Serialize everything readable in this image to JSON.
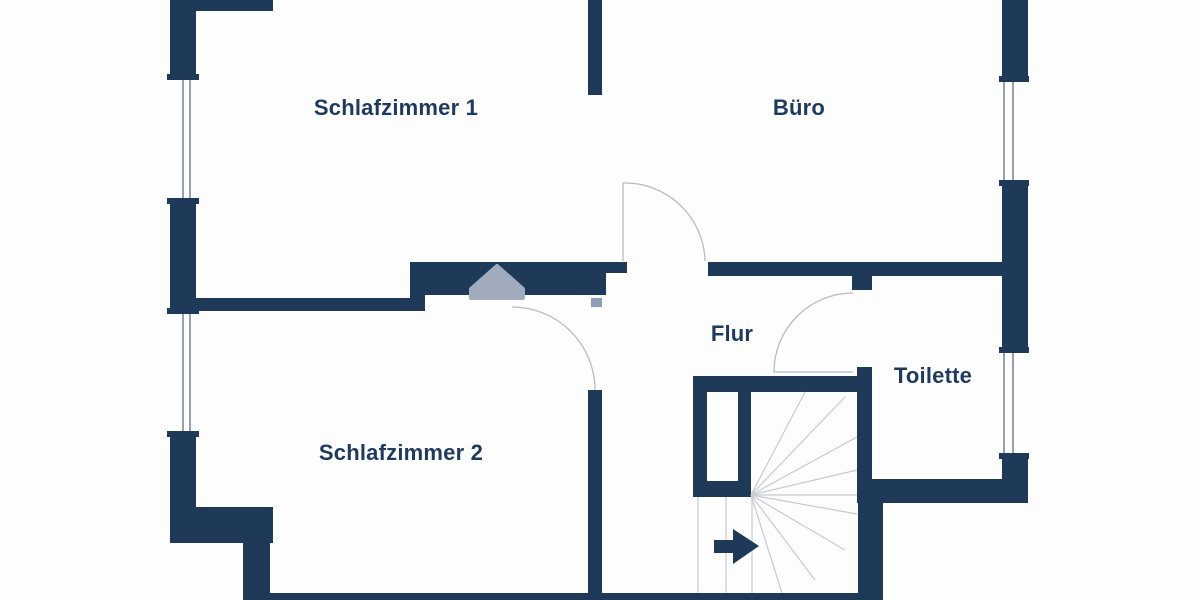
{
  "meta": {
    "type": "floor-plan",
    "language": "de"
  },
  "colors": {
    "wall": "#1f3a59",
    "text": "#1e3a5c",
    "door_arc": "#b6bcc6",
    "stair_tread": "#c6cad1",
    "window_line": "#72819a",
    "gable_symbol": "#a0acbe",
    "door_hinge": "#8fa0b5",
    "background": "#fdfdfe"
  },
  "rooms": [
    {
      "id": "schlafzimmer-1",
      "label": "Schlafzimmer 1",
      "cx": 396,
      "cy": 108
    },
    {
      "id": "buero",
      "label": "Büro",
      "cx": 799,
      "cy": 108
    },
    {
      "id": "flur",
      "label": "Flur",
      "cx": 732,
      "cy": 334
    },
    {
      "id": "toilette",
      "label": "Toilette",
      "cx": 933,
      "cy": 376
    },
    {
      "id": "schlafzimmer-2",
      "label": "Schlafzimmer 2",
      "cx": 401,
      "cy": 453
    }
  ],
  "walls": [
    [
      170,
      0,
      103,
      11
    ],
    [
      170,
      0,
      26,
      80
    ],
    [
      170,
      198,
      26,
      116
    ],
    [
      170,
      431,
      26,
      80
    ],
    [
      170,
      507,
      103,
      36
    ],
    [
      243,
      543,
      27,
      57
    ],
    [
      263,
      593,
      620,
      7
    ],
    [
      588,
      390,
      14,
      210
    ],
    [
      195,
      298,
      230,
      13
    ],
    [
      410,
      262,
      15,
      49
    ],
    [
      410,
      262,
      196,
      33
    ],
    [
      606,
      262,
      21,
      11
    ],
    [
      588,
      0,
      14,
      95
    ],
    [
      708,
      262,
      294,
      14
    ],
    [
      852,
      273,
      20,
      17
    ],
    [
      1002,
      0,
      26,
      82
    ],
    [
      1002,
      180,
      26,
      173
    ],
    [
      1002,
      453,
      26,
      50
    ],
    [
      858,
      479,
      170,
      24
    ],
    [
      857,
      367,
      15,
      136
    ],
    [
      858,
      503,
      25,
      97
    ],
    [
      693,
      376,
      164,
      16
    ],
    [
      693,
      376,
      14,
      121
    ],
    [
      738,
      390,
      13,
      107
    ],
    [
      693,
      481,
      58,
      16
    ],
    [
      167,
      74,
      32,
      6
    ],
    [
      167,
      198,
      32,
      6
    ],
    [
      167,
      308,
      32,
      6
    ],
    [
      167,
      431,
      32,
      6
    ],
    [
      999,
      76,
      30,
      6
    ],
    [
      999,
      180,
      30,
      6
    ],
    [
      999,
      347,
      30,
      6
    ],
    [
      999,
      453,
      30,
      6
    ]
  ],
  "window_lines": [
    [
      183,
      80,
      183,
      198
    ],
    [
      190,
      80,
      190,
      198
    ],
    [
      183,
      314,
      183,
      431
    ],
    [
      190,
      314,
      190,
      431
    ],
    [
      1004,
      82,
      1004,
      180
    ],
    [
      1013,
      82,
      1013,
      180
    ],
    [
      1004,
      353,
      1004,
      453
    ],
    [
      1013,
      353,
      1013,
      453
    ]
  ],
  "doors": [
    {
      "id": "buero-door",
      "arc": "M 623 183 A 80 80 0 0 1 705 261",
      "leaf": [
        623,
        183,
        623,
        261
      ]
    },
    {
      "id": "toilette-door",
      "arc": "M 853 293 A 79 79 0 0 0 774 372",
      "leaf": [
        774,
        372,
        853,
        372
      ]
    },
    {
      "id": "schlafzimmer-2-door",
      "arc": "M 512 307 A 83 83 0 0 1 595 390",
      "leaf": null
    }
  ],
  "door_hinge": {
    "x": 591,
    "y": 298,
    "w": 11,
    "h": 9
  },
  "stair": {
    "treads": [
      [
        698,
        497,
        698,
        593
      ],
      [
        726,
        497,
        726,
        593
      ],
      [
        752,
        495,
        752,
        593
      ],
      [
        751,
        495,
        857,
        495
      ],
      [
        751,
        495,
        805,
        392
      ],
      [
        751,
        495,
        845,
        397
      ],
      [
        751,
        495,
        857,
        437
      ],
      [
        751,
        495,
        857,
        470
      ],
      [
        751,
        495,
        857,
        514
      ],
      [
        751,
        495,
        845,
        550
      ],
      [
        751,
        495,
        815,
        580
      ],
      [
        751,
        495,
        782,
        593
      ]
    ],
    "arrow_points": "714,540 733,540 733,529 759,546 733,564 733,553 714,553"
  },
  "gable_points": "497,266 523,289 523,298 471,298 471,289"
}
